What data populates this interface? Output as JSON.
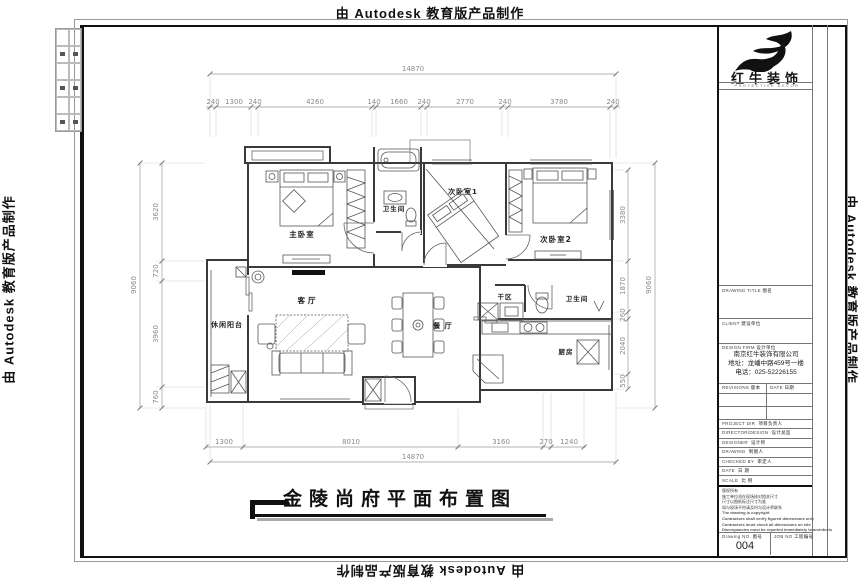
{
  "watermarks": {
    "top": "由 Autodesk 教育版产品制作",
    "bottom": "由 Autodesk 教育版产品制作",
    "left": "由 Autodesk 教育版产品制作",
    "right": "由 Autodesk 教育版产品制作"
  },
  "drawing_title": "金陵尚府平面布置图",
  "rooms": {
    "master": "主卧室",
    "bath1": "卫生间",
    "bed1": "次卧室1",
    "bed2": "次卧室2",
    "living": "客厅",
    "dining": "餐 厅",
    "balcony": "休闲阳台",
    "dry": "干区",
    "bath2": "卫生间",
    "kitchen": "厨房"
  },
  "dims": {
    "top_total": "14870",
    "top_segments": [
      "240",
      "1300",
      "240",
      "4260",
      "140",
      "1660",
      "240",
      "2770",
      "240",
      "3780",
      "240"
    ],
    "bottom_total": "14870",
    "bottom_segments": [
      "1300",
      "8010",
      "3160",
      "270",
      "1240"
    ],
    "left_total": "9060",
    "left_segments": [
      "3620",
      "720",
      "3960",
      "760"
    ],
    "right_total": "9060",
    "right_segments": [
      "3380",
      "1870",
      "260",
      "2040",
      "550"
    ]
  },
  "title_block": {
    "brand": "红牛装饰",
    "brand_sub": "PROTECTIVE DECOR",
    "drawing_title_label": {
      "en": "DRAWING TITLE",
      "zh": "图名"
    },
    "client_label": {
      "en": "CLIENT",
      "zh": "建设单位"
    },
    "design_firm_label": {
      "en": "DESIGN FIRM",
      "zh": "设计单位"
    },
    "company": {
      "name": "南京红牛装饰有限公司",
      "address": "地址：龙蟠中路459号一楼",
      "phone": "电话：025-52226155"
    },
    "revisions_label": {
      "en": "REVISIONS",
      "zh": "版本"
    },
    "date_col_label": {
      "en": "DATE",
      "zh": "日期"
    },
    "rows": [
      {
        "en": "PROJECT DIR",
        "zh": "项目负责人"
      },
      {
        "en": "DIRECTOR/DESIGN",
        "zh": "设计总监"
      },
      {
        "en": "DESIGNER",
        "zh": "设计师"
      },
      {
        "en": "DRAWING",
        "zh": "制图人"
      },
      {
        "en": "CHECKED BY",
        "zh": "审定人"
      },
      {
        "en": "DATE",
        "zh": "日 期"
      },
      {
        "en": "SCALE",
        "zh": "比 例"
      }
    ],
    "notes": [
      "版权所有",
      "施工单位须在现场核对相关尺寸",
      "尺寸以图纸标注尺寸为准",
      "如与现场不符请及时与设计师联系",
      "The drawing is copyright",
      "Contractors shall verify figured dimensions only",
      "Contractors must check all dimensions on site",
      "Discrepancies must be reported immediately to architects"
    ],
    "drawing_no_label": {
      "en": "Drawing NO.",
      "zh": "图号"
    },
    "drawing_no": "004",
    "job_no_label": {
      "en": "JOB NO",
      "zh": "工程编号"
    }
  }
}
